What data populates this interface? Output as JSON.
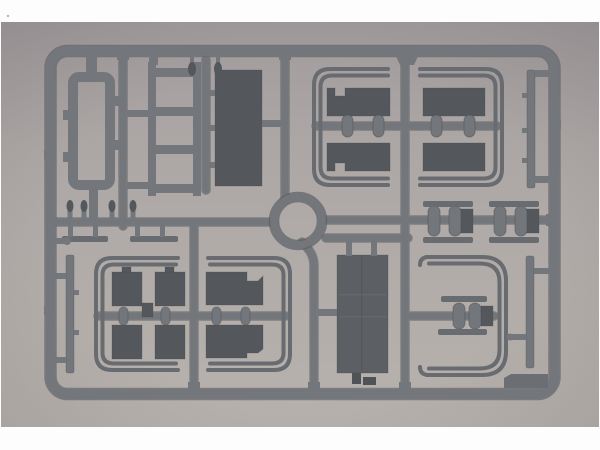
{
  "image": {
    "type": "photograph",
    "subject": "plastic model kit sprue",
    "description": "Top-down photograph of a gray injection-moulded styrene sprue (rounded rectangular runner frame) holding flat model parts: rectangular panels, a ladder rack, U-shaped double running-board rails with notched panels, wheel-hub capsules, long thin strips, a central circular ring and a small corner tab, on a plain light-gray surface with white photo margins."
  },
  "colors": {
    "page_bg": "#fdfdfd",
    "photo_bg_top": "#a19b9d",
    "photo_bg_mid": "#aca6a5",
    "photo_bg_low": "#b3adaa",
    "photo_bg_bottom": "#b8b2ae",
    "plastic": "#73767b",
    "plastic_edge": "#5d6065",
    "rail_thin": "#686b70",
    "panel_dark": "#54585c",
    "panel_medium": "#5c5f63",
    "tab_gray": "#6b6e73",
    "block_dark": "#4f5256"
  },
  "sprue": {
    "frame_shape": "rounded-rectangle runner frame",
    "ring": {
      "shape": "circle",
      "position": "center"
    },
    "parts": [
      {
        "id": "open-rectangular-frame",
        "zone": "top-left",
        "desc": "open rectangular frame part"
      },
      {
        "id": "ladder-rack",
        "zone": "top-left",
        "desc": "ladder rack with four rungs"
      },
      {
        "id": "tall-panel",
        "zone": "top-center",
        "desc": "solid dark rectangular panel"
      },
      {
        "id": "u-rail-top-left",
        "zone": "top-right",
        "desc": "U-shaped double rail, two notched panels, two hub capsules"
      },
      {
        "id": "u-rail-top-right",
        "zone": "top-right",
        "desc": "mirrored U-shaped double rail, two panels, two hub capsules"
      },
      {
        "id": "thin-strip-upper-right",
        "zone": "right edge",
        "desc": "long thin strip"
      },
      {
        "id": "central-ring",
        "zone": "center",
        "desc": "circular ring part"
      },
      {
        "id": "hub-group-left",
        "zone": "mid-right",
        "desc": "two hub capsules and block between thin bars"
      },
      {
        "id": "hub-group-right",
        "zone": "mid-right",
        "desc": "two hub capsules and block between thin bars"
      },
      {
        "id": "thin-bars-mid-left",
        "zone": "mid-left",
        "desc": "two thin flat bars"
      },
      {
        "id": "thin-strip-left",
        "zone": "left edge",
        "desc": "long thin strip"
      },
      {
        "id": "u-rail-bottom-left",
        "zone": "bottom-left",
        "desc": "U-shaped double rail with four square panels"
      },
      {
        "id": "u-rail-bottom-middle",
        "zone": "bottom-middle",
        "desc": "mirrored U-shaped double rail with two notched panels"
      },
      {
        "id": "door-panel",
        "zone": "bottom-center",
        "desc": "large rectangular door panel"
      },
      {
        "id": "c-shaped-rail",
        "zone": "bottom-right",
        "desc": "C-shaped double rail with axle runner and two hubs"
      },
      {
        "id": "thin-strip-lower-right",
        "zone": "bottom-right",
        "desc": "long thin strip"
      },
      {
        "id": "corner-tab",
        "zone": "bottom-right corner",
        "desc": "small molded tab"
      }
    ]
  }
}
